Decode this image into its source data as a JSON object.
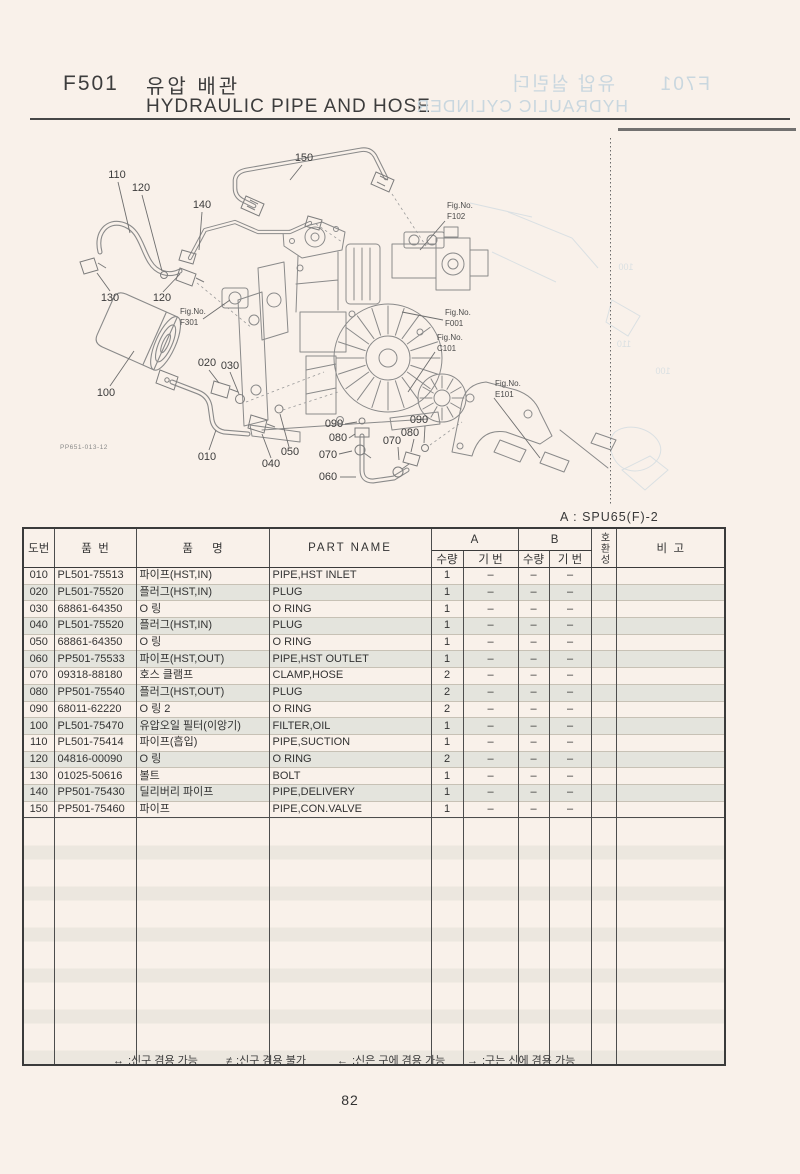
{
  "page": {
    "code": "F501",
    "title_kr": "유압 배관",
    "title_en": "HYDRAULIC PIPE AND HOSE",
    "variant_note": "A : SPU65(F)-2",
    "page_number": "82",
    "bleedthrough_title": {
      "code": "F701",
      "title_kr": "유압 실린더",
      "title_en": "HYDRAULIC CYLINDER"
    }
  },
  "colors": {
    "paper": "#f9f1ea",
    "line": "#3b3b3b",
    "drawing": "#8a8a8a",
    "stripe": "#e4e4dd",
    "bleed": "#c9d7df"
  },
  "diagram": {
    "ref_code": "PP651-013-12",
    "fig_prefix": "Fig.No.",
    "fig_labels": [
      "F102",
      "F001",
      "C101",
      "E101",
      "F301"
    ],
    "callouts": [
      "150",
      "110",
      "120",
      "140",
      "130",
      "120",
      "100",
      "020",
      "030",
      "010",
      "040",
      "050",
      "060",
      "070",
      "080",
      "090",
      "070",
      "080",
      "090"
    ],
    "bleed_labels": [
      "100",
      "110",
      "100"
    ]
  },
  "table": {
    "headers": {
      "no": "도번",
      "part_no": "품  번",
      "name_kr": "품      명",
      "part_name": "PART NAME",
      "col_a": "A",
      "col_b": "B",
      "qty": "수량",
      "ref": "기 번",
      "compat": "호환성",
      "remarks": "비  고"
    },
    "rows": [
      {
        "no": "010",
        "part_no": "PL501-75513",
        "name_kr": "파이프(HST,IN)",
        "name_en": "PIPE,HST INLET",
        "qty_a": "1",
        "ref_a": "–",
        "qty_b": "–",
        "ref_b": "–",
        "compat": "",
        "remarks": ""
      },
      {
        "no": "020",
        "part_no": "PL501-75520",
        "name_kr": "플러그(HST,IN)",
        "name_en": "PLUG",
        "qty_a": "1",
        "ref_a": "–",
        "qty_b": "–",
        "ref_b": "–",
        "compat": "",
        "remarks": ""
      },
      {
        "no": "030",
        "part_no": "68861-64350",
        "name_kr": "O 링",
        "name_en": "O RING",
        "qty_a": "1",
        "ref_a": "–",
        "qty_b": "–",
        "ref_b": "–",
        "compat": "",
        "remarks": ""
      },
      {
        "no": "040",
        "part_no": "PL501-75520",
        "name_kr": "플러그(HST,IN)",
        "name_en": "PLUG",
        "qty_a": "1",
        "ref_a": "–",
        "qty_b": "–",
        "ref_b": "–",
        "compat": "",
        "remarks": ""
      },
      {
        "no": "050",
        "part_no": "68861-64350",
        "name_kr": "O 링",
        "name_en": "O RING",
        "qty_a": "1",
        "ref_a": "–",
        "qty_b": "–",
        "ref_b": "–",
        "compat": "",
        "remarks": ""
      },
      {
        "no": "060",
        "part_no": "PP501-75533",
        "name_kr": "파이프(HST,OUT)",
        "name_en": "PIPE,HST OUTLET",
        "qty_a": "1",
        "ref_a": "–",
        "qty_b": "–",
        "ref_b": "–",
        "compat": "",
        "remarks": ""
      },
      {
        "no": "070",
        "part_no": "09318-88180",
        "name_kr": "호스 클램프",
        "name_en": "CLAMP,HOSE",
        "qty_a": "2",
        "ref_a": "–",
        "qty_b": "–",
        "ref_b": "–",
        "compat": "",
        "remarks": ""
      },
      {
        "no": "080",
        "part_no": "PP501-75540",
        "name_kr": "플러그(HST,OUT)",
        "name_en": "PLUG",
        "qty_a": "2",
        "ref_a": "–",
        "qty_b": "–",
        "ref_b": "–",
        "compat": "",
        "remarks": ""
      },
      {
        "no": "090",
        "part_no": "68011-62220",
        "name_kr": "O 링 2",
        "name_en": "O RING",
        "qty_a": "2",
        "ref_a": "–",
        "qty_b": "–",
        "ref_b": "–",
        "compat": "",
        "remarks": ""
      },
      {
        "no": "100",
        "part_no": "PL501-75470",
        "name_kr": "유압오일 필터(이앙기)",
        "name_en": "FILTER,OIL",
        "qty_a": "1",
        "ref_a": "–",
        "qty_b": "–",
        "ref_b": "–",
        "compat": "",
        "remarks": ""
      },
      {
        "no": "110",
        "part_no": "PL501-75414",
        "name_kr": "파이프(흡입)",
        "name_en": "PIPE,SUCTION",
        "qty_a": "1",
        "ref_a": "–",
        "qty_b": "–",
        "ref_b": "–",
        "compat": "",
        "remarks": ""
      },
      {
        "no": "120",
        "part_no": "04816-00090",
        "name_kr": "O 링",
        "name_en": "O RING",
        "qty_a": "2",
        "ref_a": "–",
        "qty_b": "–",
        "ref_b": "–",
        "compat": "",
        "remarks": ""
      },
      {
        "no": "130",
        "part_no": "01025-50616",
        "name_kr": "볼트",
        "name_en": "BOLT",
        "qty_a": "1",
        "ref_a": "–",
        "qty_b": "–",
        "ref_b": "–",
        "compat": "",
        "remarks": ""
      },
      {
        "no": "140",
        "part_no": "PP501-75430",
        "name_kr": "딜리버리 파이프",
        "name_en": "PIPE,DELIVERY",
        "qty_a": "1",
        "ref_a": "–",
        "qty_b": "–",
        "ref_b": "–",
        "compat": "",
        "remarks": ""
      },
      {
        "no": "150",
        "part_no": "PP501-75460",
        "name_kr": "파이프",
        "name_en": "PIPE,CON.VALVE",
        "qty_a": "1",
        "ref_a": "–",
        "qty_b": "–",
        "ref_b": "–",
        "compat": "",
        "remarks": ""
      }
    ]
  },
  "legend": [
    {
      "symbol": "↔",
      "text": ";신구 겸용 가능"
    },
    {
      "symbol": "≠",
      "text": ";신구 겸용 불가"
    },
    {
      "symbol": "←",
      "text": ";신은 구에 겸용 가능"
    },
    {
      "symbol": "→",
      "text": ";구는 신에 겸용 가능"
    }
  ]
}
